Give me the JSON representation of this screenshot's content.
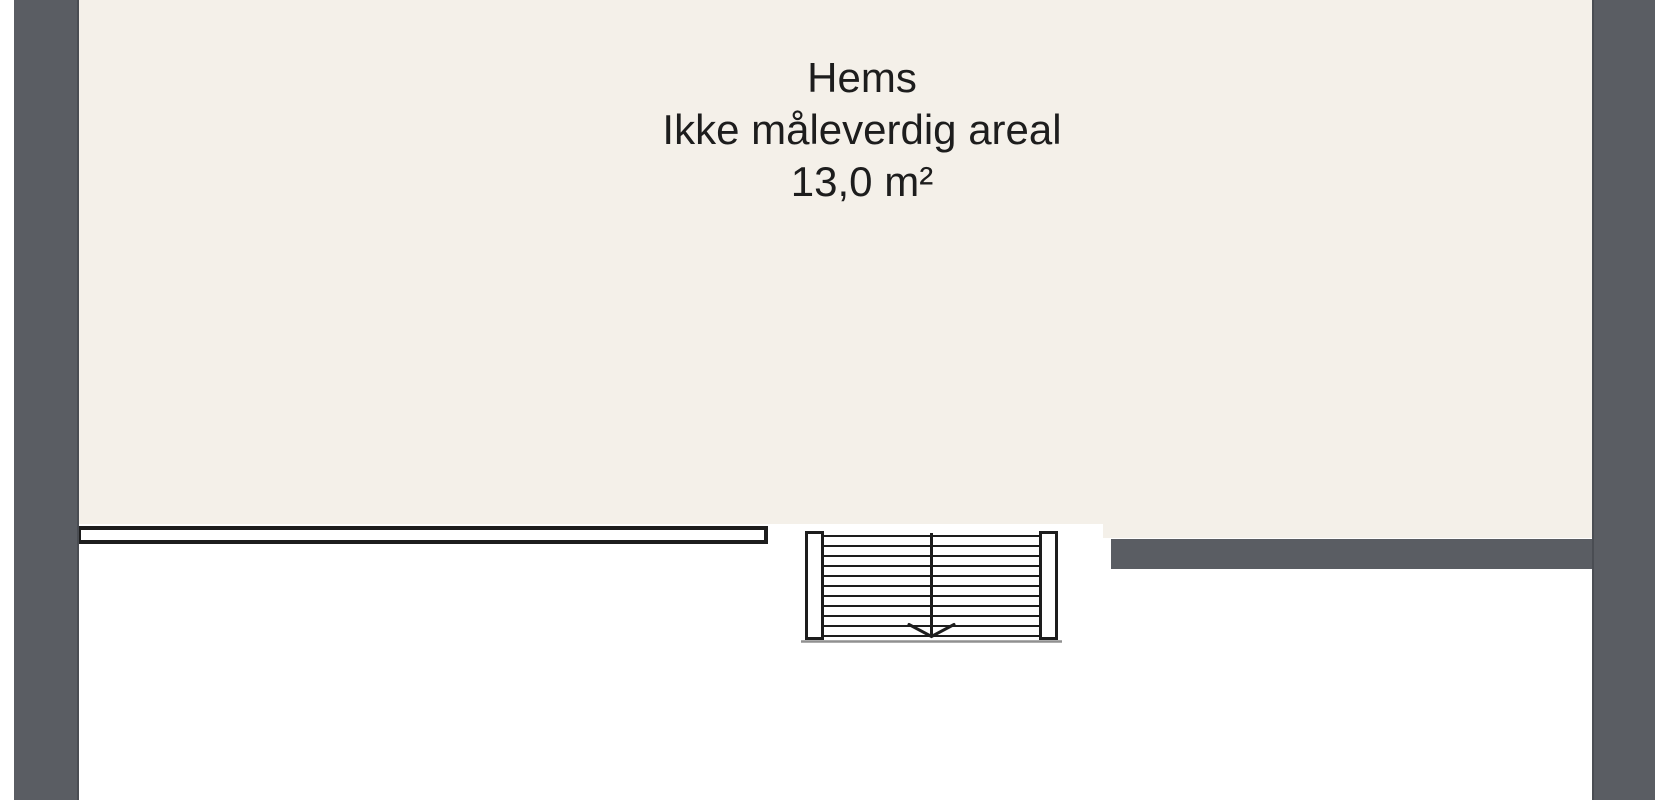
{
  "room_label": {
    "name": "Hems",
    "description": "Ikke måleverdig areal",
    "area": "13,0 m²"
  },
  "colors": {
    "background": "#ffffff",
    "floor": "#f4f0e9",
    "wall": "#5a5d63",
    "wall_edge": "#4a4d53",
    "line": "#1d1d1d",
    "shadow": "#909090"
  },
  "staircase": {
    "tread_count": 11,
    "direction": "down",
    "arrow_icon": "arrow-down"
  }
}
